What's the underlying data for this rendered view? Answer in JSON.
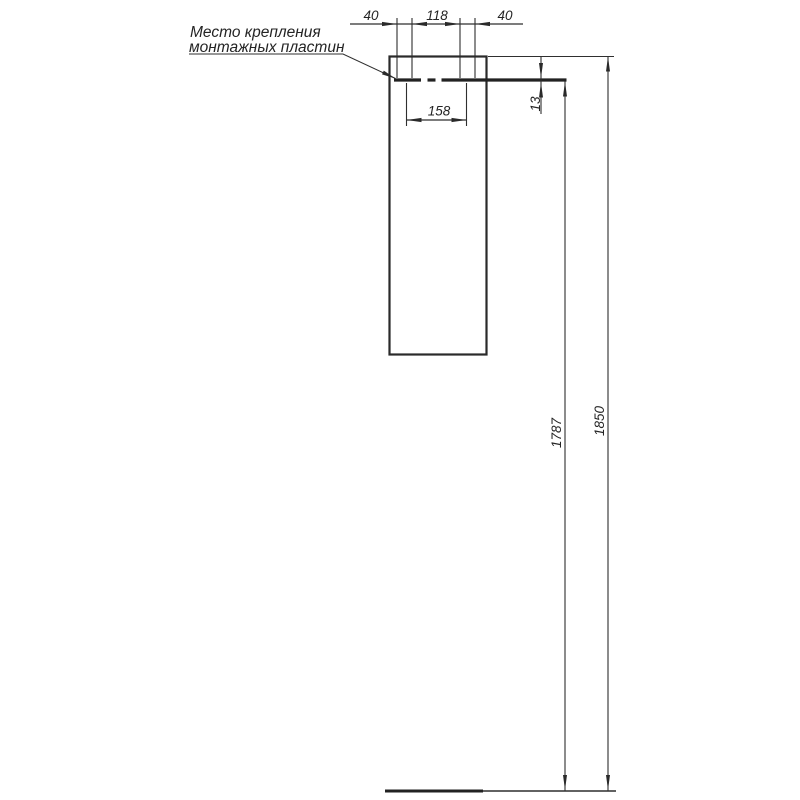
{
  "note": {
    "line1": "Место крепления",
    "line2": "монтажных пластин"
  },
  "dims": {
    "top_left_offset": "40",
    "top_center_span": "118",
    "top_right_offset": "40",
    "plate_span": "158",
    "plate_thickness": "13",
    "mount_height": "1787",
    "total_height": "1850"
  },
  "colors": {
    "background": "#ffffff",
    "stroke": "#2f2f2f",
    "text": "#242424"
  }
}
